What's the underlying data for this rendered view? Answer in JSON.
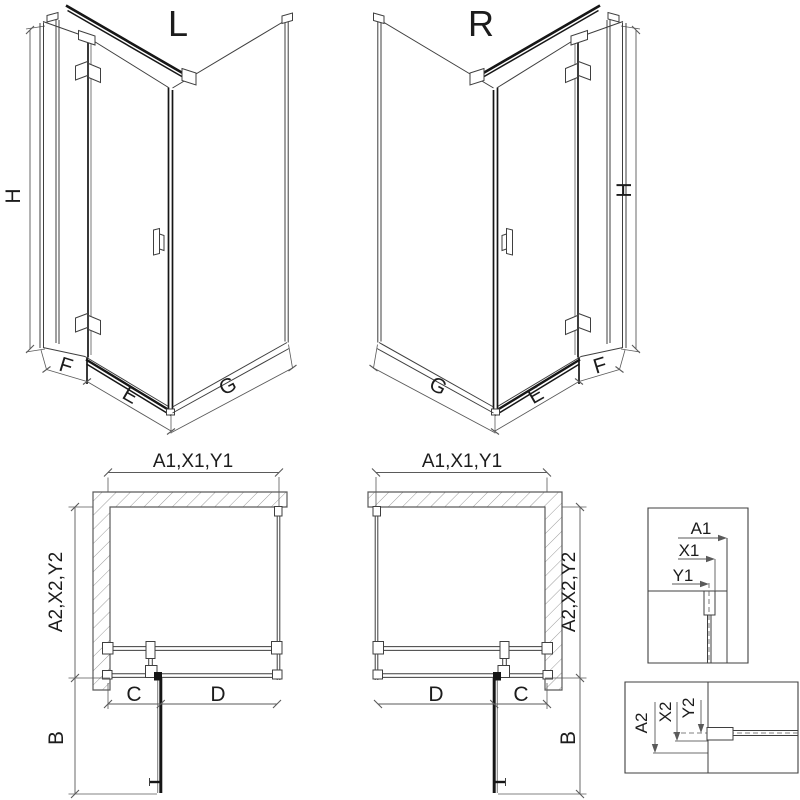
{
  "colors": {
    "background": "#ffffff",
    "line": "#3f3f3f",
    "dark": "#161616",
    "dim": "#5a5a5a",
    "wall_stroke": "#5a5a5a",
    "hatch": "#9b9b9b",
    "text": "#1c1c1c"
  },
  "iso_left": {
    "label": "L",
    "height": "H",
    "fixed": "F",
    "door": "E",
    "side": "G"
  },
  "iso_right": {
    "label": "R",
    "height": "H",
    "fixed": "F",
    "door": "E",
    "side": "G"
  },
  "plan_left": {
    "width": "A1,X1,Y1",
    "depth": "A2,X2,Y2",
    "fixed": "C",
    "door": "D",
    "swing": "B"
  },
  "plan_right": {
    "width": "A1,X1,Y1",
    "depth": "A2,X2,Y2",
    "fixed": "C",
    "door": "D",
    "swing": "B"
  },
  "detail_width": {
    "total": "A1",
    "mid": "X1",
    "inner": "Y1"
  },
  "detail_depth": {
    "total": "A2",
    "mid": "X2",
    "inner": "Y2"
  }
}
